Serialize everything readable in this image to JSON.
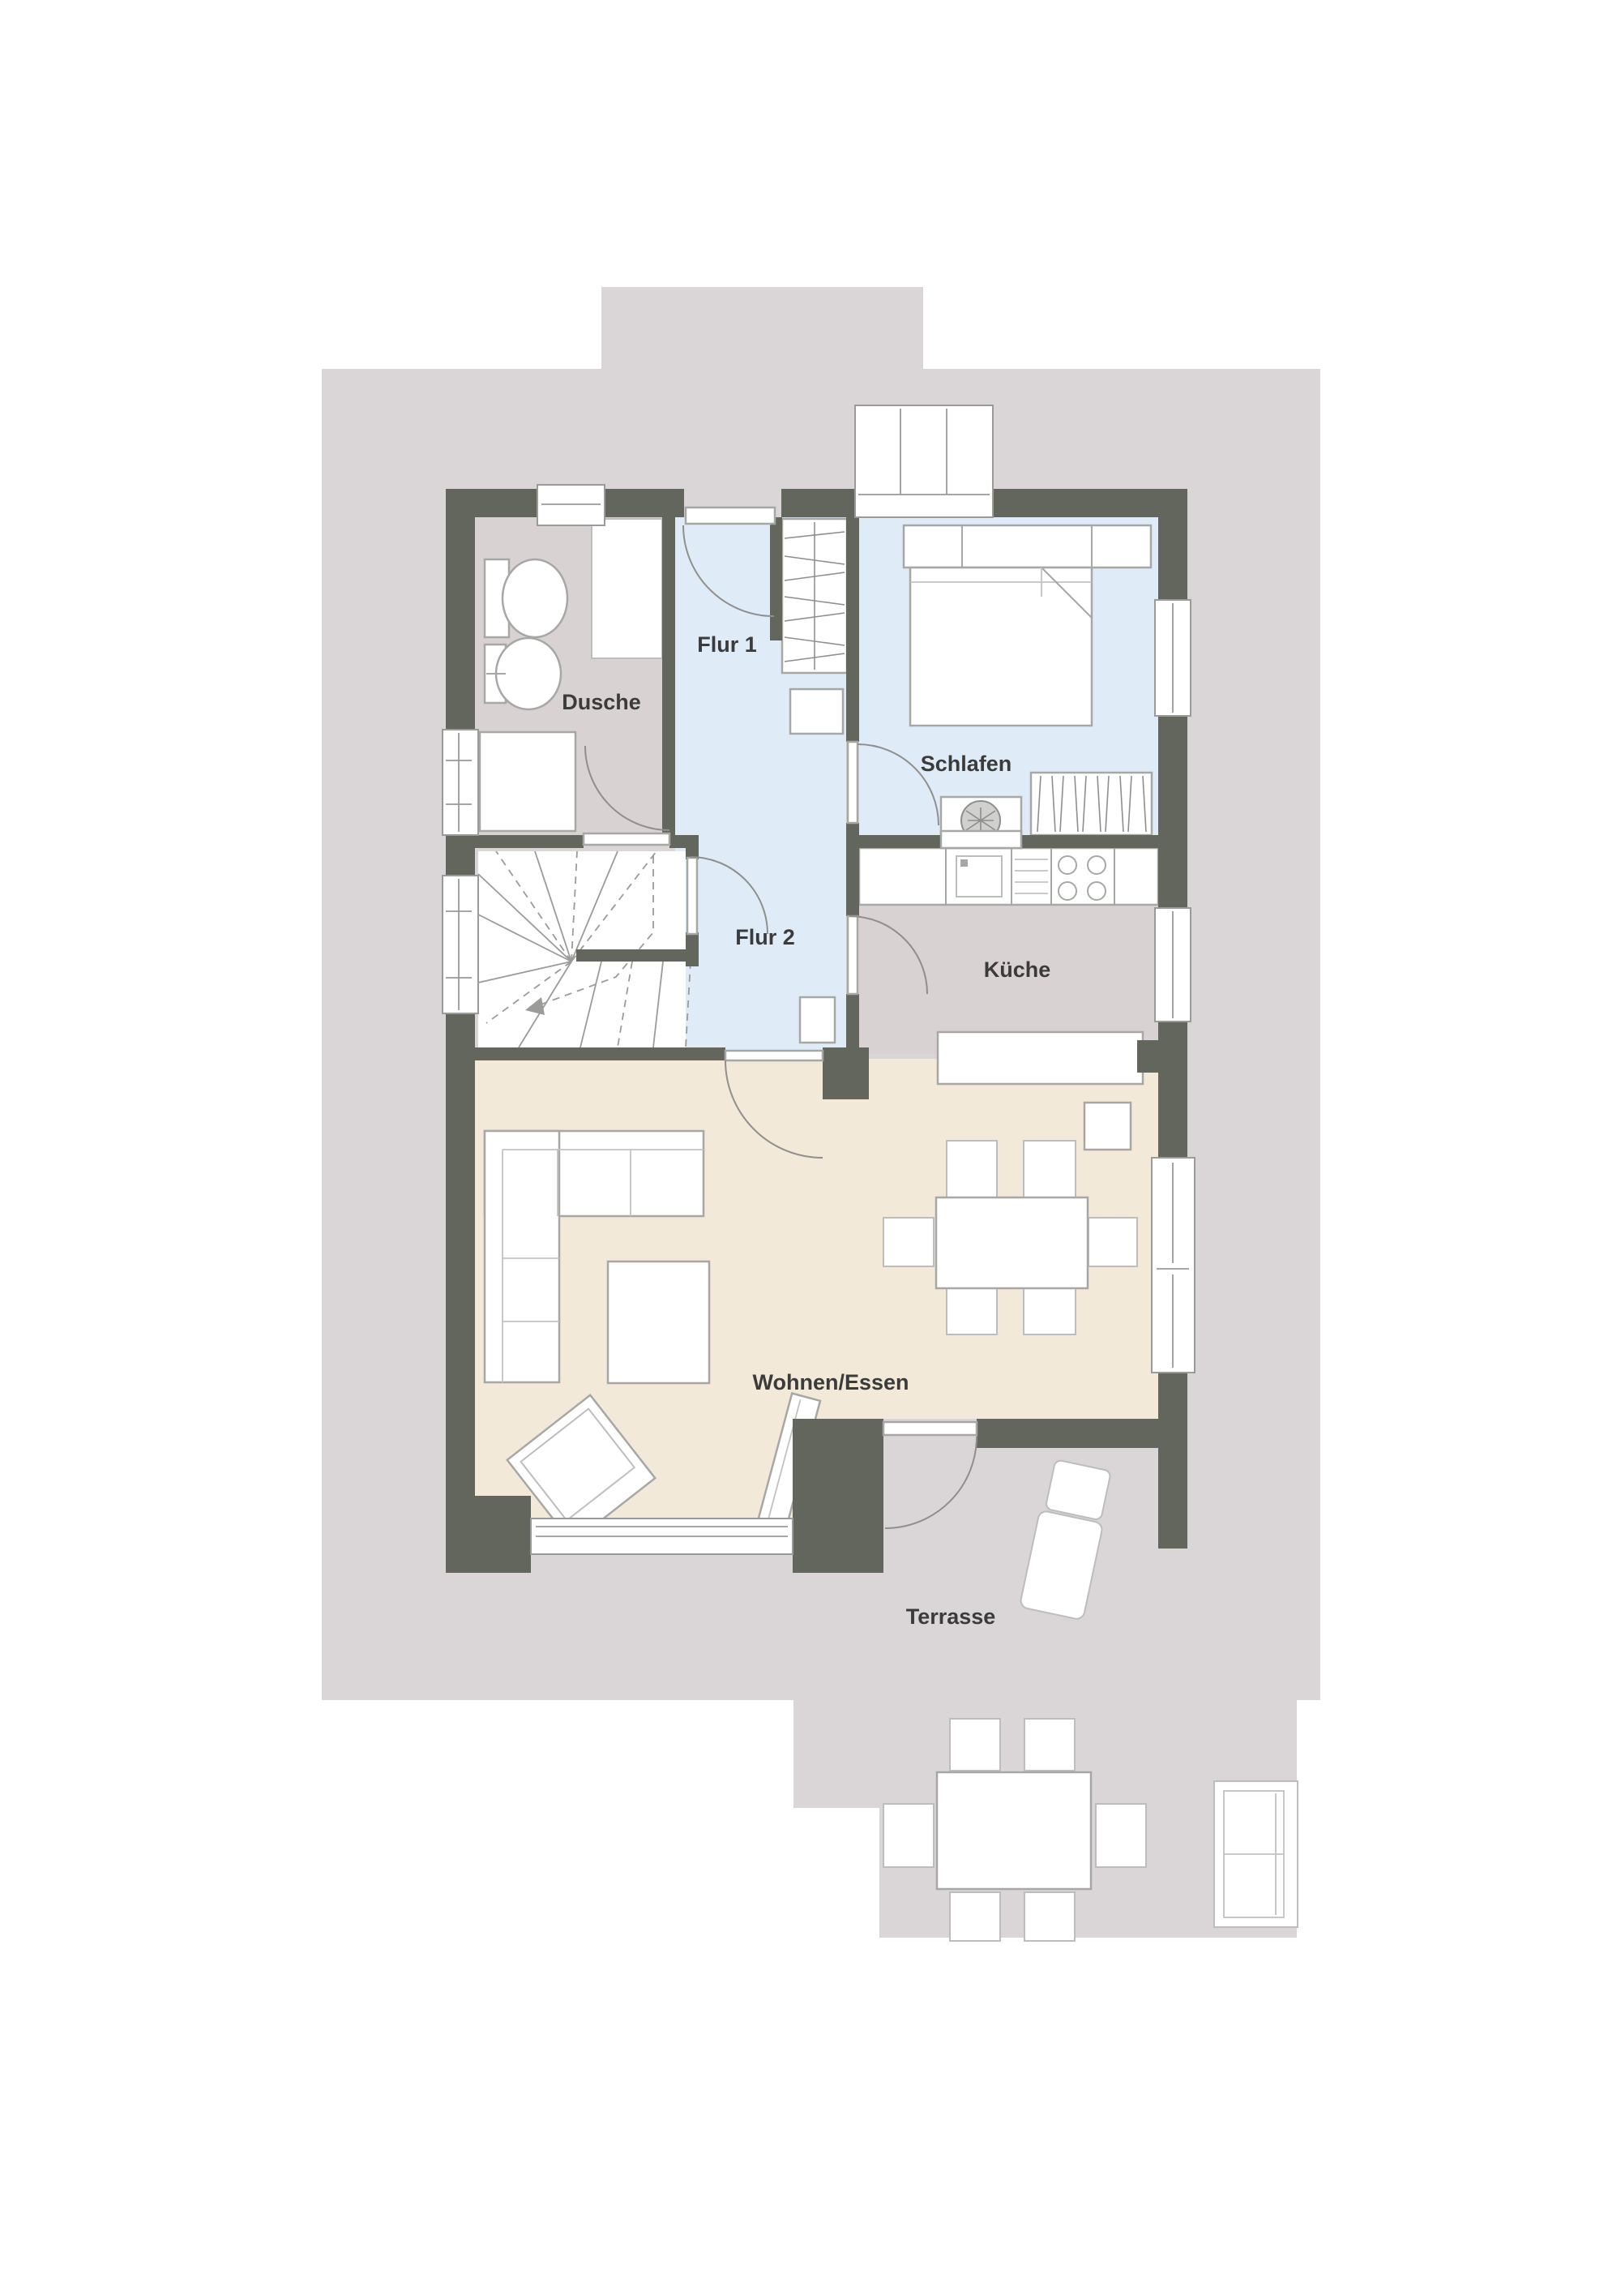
{
  "plan": {
    "type": "residential-floor-plan",
    "floor": "ground-floor",
    "rooms": {
      "flur1": {
        "label": "Flur 1"
      },
      "dusche": {
        "label": "Dusche"
      },
      "schlafen": {
        "label": "Schlafen"
      },
      "flur2": {
        "label": "Flur 2"
      },
      "kueche": {
        "label": "Küche"
      },
      "wohnen": {
        "label": "Wohnen/Essen"
      },
      "terrasse": {
        "label": "Terrasse"
      }
    }
  },
  "colors": {
    "terrace": "#dad6d7",
    "wall": "#62665c",
    "hall_blue": "#dfecf8",
    "bedroom_blue": "#dfecf8",
    "living_beige": "#f2e9d8",
    "kitchen_gray": "#d8d3d2",
    "bath_gray": "#d8d3d2",
    "furniture_white": "#ffffff",
    "outline_gray": "#a7a7a5",
    "label_text": "#3b3b3b"
  }
}
